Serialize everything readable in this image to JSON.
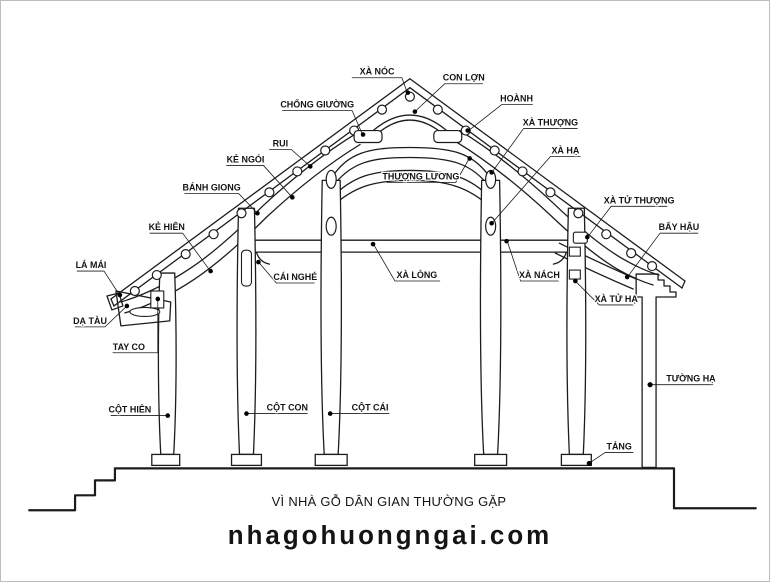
{
  "page": {
    "title": "VÌ NHÀ GỖ DÂN GIAN THƯỜNG GẶP",
    "watermark": "nhagohuongngai.com",
    "watermark_color": "#7d0f08",
    "ink_color": "#1c1c1c",
    "wall_fill": "#d9d9d9"
  },
  "diagram": {
    "labels": {
      "xa_noc": "XÀ NÓC",
      "con_lon": "CON LỢN",
      "hoanh": "HOÀNH",
      "chong_giuong": "CHỐNG GIƯỜNG",
      "rui": "RUI",
      "ke_ngoi": "KẺ NGÓI",
      "banh_giong": "BÁNH GIONG",
      "thuong_luong": "THƯỢNG LƯƠNG",
      "xa_thuong": "XÀ THƯỢNG",
      "xa_ha": "XÀ HẠ",
      "ke_hien": "KẺ HIÊN",
      "xa_tu_thuong": "XÀ TỬ THƯỢNG",
      "bay_hau": "BẨY HẬU",
      "la_mai": "LÁ MÁI",
      "cai_nghe": "CÁI NGHÉ",
      "xa_long": "XÀ LÒNG",
      "xa_nach": "XÀ NÁCH",
      "xa_tu_ha": "XÀ TỬ HẠ",
      "da_tau": "DẠ TÀU",
      "tay_co": "TAY CO",
      "tuong_ha": "TƯỜNG HẠ",
      "cot_hien": "CỘT HIÊN",
      "cot_con": "CỘT CON",
      "cot_cai": "CỘT CÁI",
      "tang": "TẢNG"
    }
  }
}
